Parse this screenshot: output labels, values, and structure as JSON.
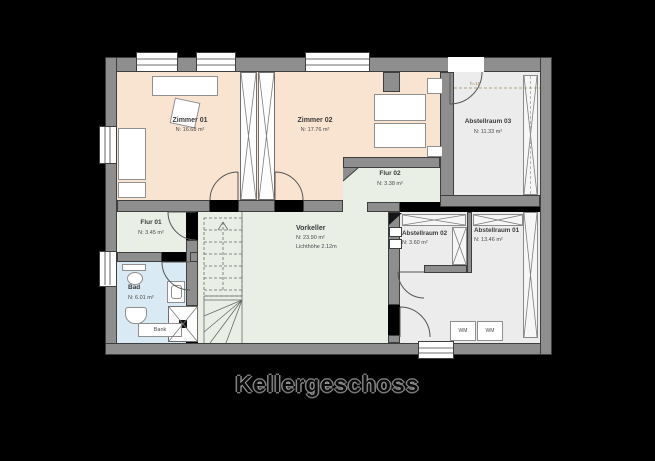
{
  "title": "Kellergeschoss",
  "palette": {
    "background": "#000000",
    "wall": "#8e8e8e",
    "room_peach": "#f9e4d1",
    "room_green": "#e9efe5",
    "room_blue": "#d9eaf4",
    "room_gray": "#ececec",
    "line": "#3e3e3e"
  },
  "rooms": {
    "zimmer01": {
      "name": "Zimmer 01",
      "area": "N: 16.68 m²"
    },
    "zimmer02": {
      "name": "Zimmer 02",
      "area": "N: 17.76 m²"
    },
    "abstellraum03": {
      "name": "Abstellraum 03",
      "area": "N: 11.33 m²"
    },
    "flur02": {
      "name": "Flur 02",
      "area": "N: 3.38 m²"
    },
    "flur01": {
      "name": "Flur 01",
      "area": "N: 3.45 m²"
    },
    "bad": {
      "name": "Bad",
      "area": "N: 6.01 m²"
    },
    "vorkeller": {
      "name": "Vorkeller",
      "area": "N: 23.90 m²",
      "note": "Lichthöhe 2.12m"
    },
    "abstellraum02": {
      "name": "Abstellraum 02",
      "area": "N: 3.60 m²"
    },
    "abstellraum01": {
      "name": "Abstellraum 01",
      "area": "N: 13.46 m²"
    }
  },
  "annotations": {
    "bench": "Bank",
    "washer1": "WM",
    "washer2": "WM",
    "height_marker": "h=15"
  }
}
